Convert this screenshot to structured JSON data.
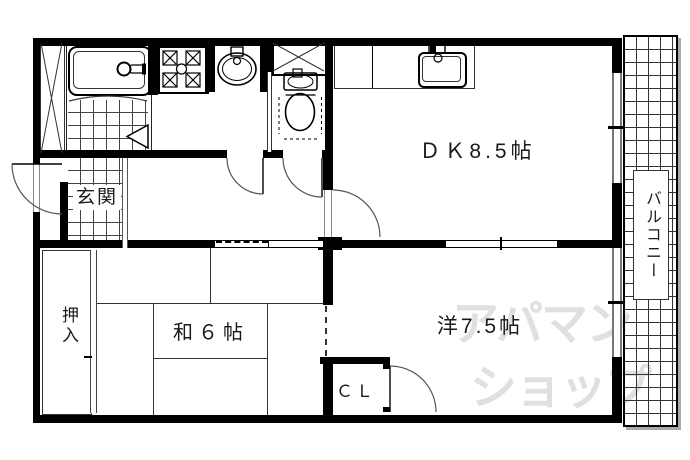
{
  "floorplan": {
    "type": "apartment-floor-plan",
    "rooms": {
      "dk": "ＤＫ8.5帖",
      "washitsu": "和６帖",
      "youshitsu": "洋7.5帖",
      "genkan": "玄関",
      "oshiire": "押入",
      "closet": "ＣＬ",
      "balcony": "バルコニー"
    },
    "watermark": {
      "line1": "アパマン",
      "line2": "ショップ"
    },
    "fixtures": [
      "bathtub",
      "bathroom-tiles",
      "folding-door",
      "gas-stove",
      "washbasin",
      "toilet",
      "storage-x",
      "pipe-space-x",
      "kitchen-sink",
      "kitchen-counter",
      "entry-door",
      "hinged-doors",
      "sliding-doors",
      "windows",
      "balcony-grid"
    ],
    "colors": {
      "wall": "#000000",
      "line": "#333333",
      "window": "#777777",
      "watermark": "#e0e0e0",
      "background": "#ffffff"
    }
  }
}
